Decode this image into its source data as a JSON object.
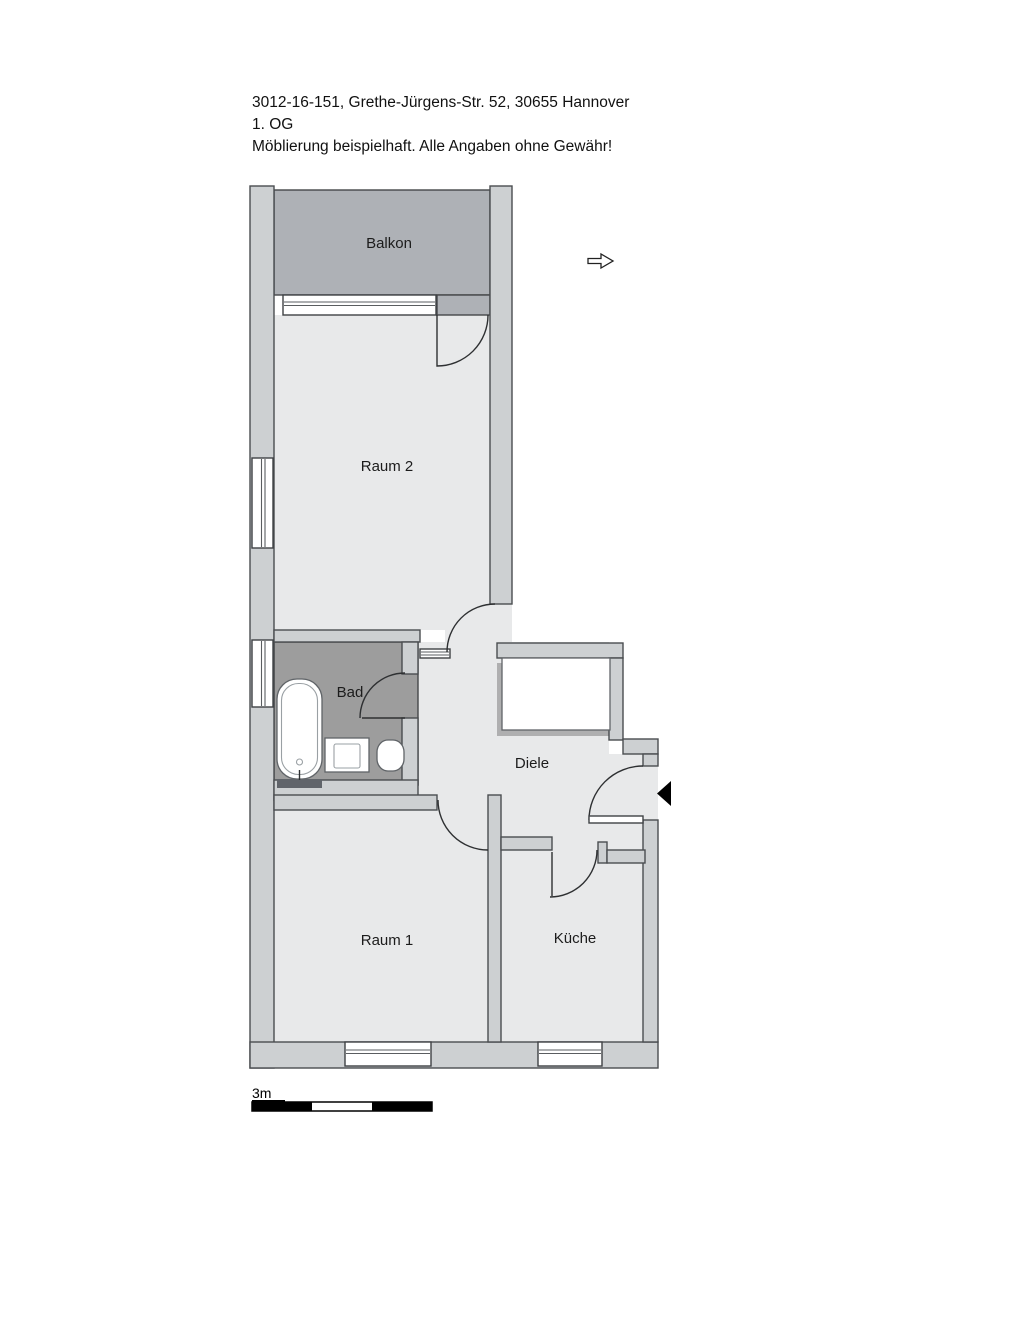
{
  "header": {
    "line1": "3012-16-151, Grethe-Jürgens-Str. 52, 30655 Hannover",
    "line2": "1. OG",
    "line3": "Möblierung beispielhaft. Alle Angaben ohne Gewähr!"
  },
  "floorplan": {
    "rooms": {
      "balkon": {
        "label": "Balkon"
      },
      "raum2": {
        "label": "Raum 2"
      },
      "bad": {
        "label": "Bad"
      },
      "diele": {
        "label": "Diele"
      },
      "raum1": {
        "label": "Raum 1"
      },
      "kueche": {
        "label": "Küche"
      }
    },
    "fixtures": [
      "bathtub",
      "washbasin",
      "wc",
      "wardrobe"
    ],
    "symbols": {
      "north_arrow": "outlined arrow pointing right",
      "entrance_marker": "solid black triangle pointing left at apartment door"
    }
  },
  "scale_bar": {
    "label": "3m",
    "segments": 3
  },
  "colors": {
    "wall": "#cdd0d2",
    "room": "#e8e9ea",
    "bad_floor": "#9d9d9d",
    "balkon_floor": "#aeb1b6",
    "outline": "#4a4d50",
    "entrance_marker": "#000000"
  }
}
